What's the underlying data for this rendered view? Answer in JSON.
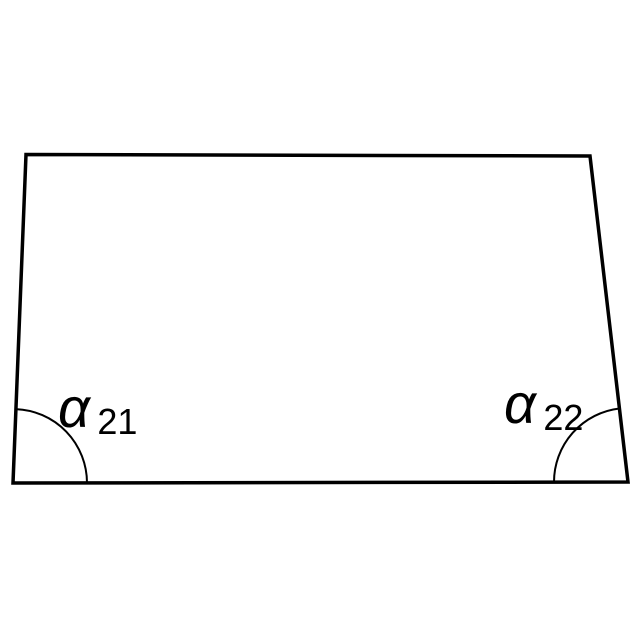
{
  "diagram": {
    "type": "trapezoid-angle-diagram",
    "background_color": "#ffffff",
    "line_color": "#000000",
    "angle_labels": {
      "left": {
        "symbol": "α",
        "subscript": "21"
      },
      "right": {
        "symbol": "α",
        "subscript": "22"
      }
    }
  }
}
